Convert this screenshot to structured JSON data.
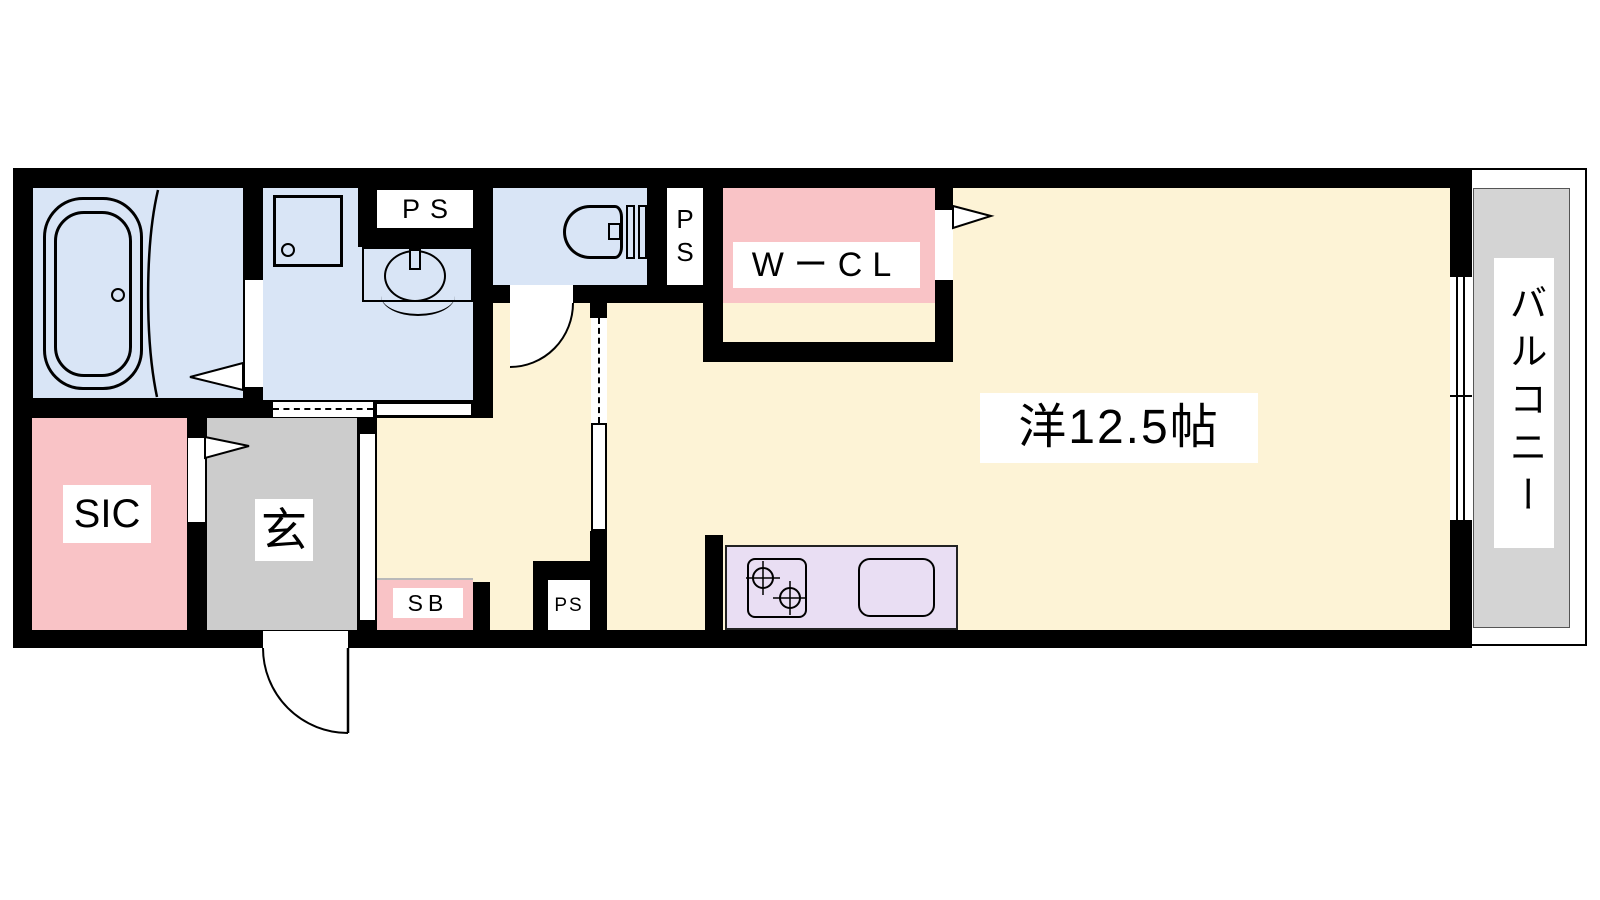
{
  "plan": {
    "title": "1R apartment floor plan",
    "rooms": {
      "main_room": {
        "label": "洋12.5帖"
      },
      "walk_in_closet": {
        "label": "WーCL"
      },
      "balcony": {
        "label": "バルコニー"
      },
      "shoe_closet": {
        "label": "SIC"
      },
      "entrance": {
        "label": "玄"
      },
      "shoe_box": {
        "label": "SB"
      },
      "pipe_space_top": {
        "label": "PS"
      },
      "pipe_space_toilet": {
        "label": "PS"
      },
      "pipe_space_kitchen": {
        "label": "PS"
      }
    },
    "colors": {
      "wall": "#000000",
      "wet_rooms_blue": "#d9e5f6",
      "closet_pink": "#f9c3c6",
      "living_cream": "#fdf3d6",
      "entrance_gray": "#cccccc",
      "balcony_gray": "#d4d4d4",
      "kitchen_lavender": "#e9def3"
    }
  }
}
